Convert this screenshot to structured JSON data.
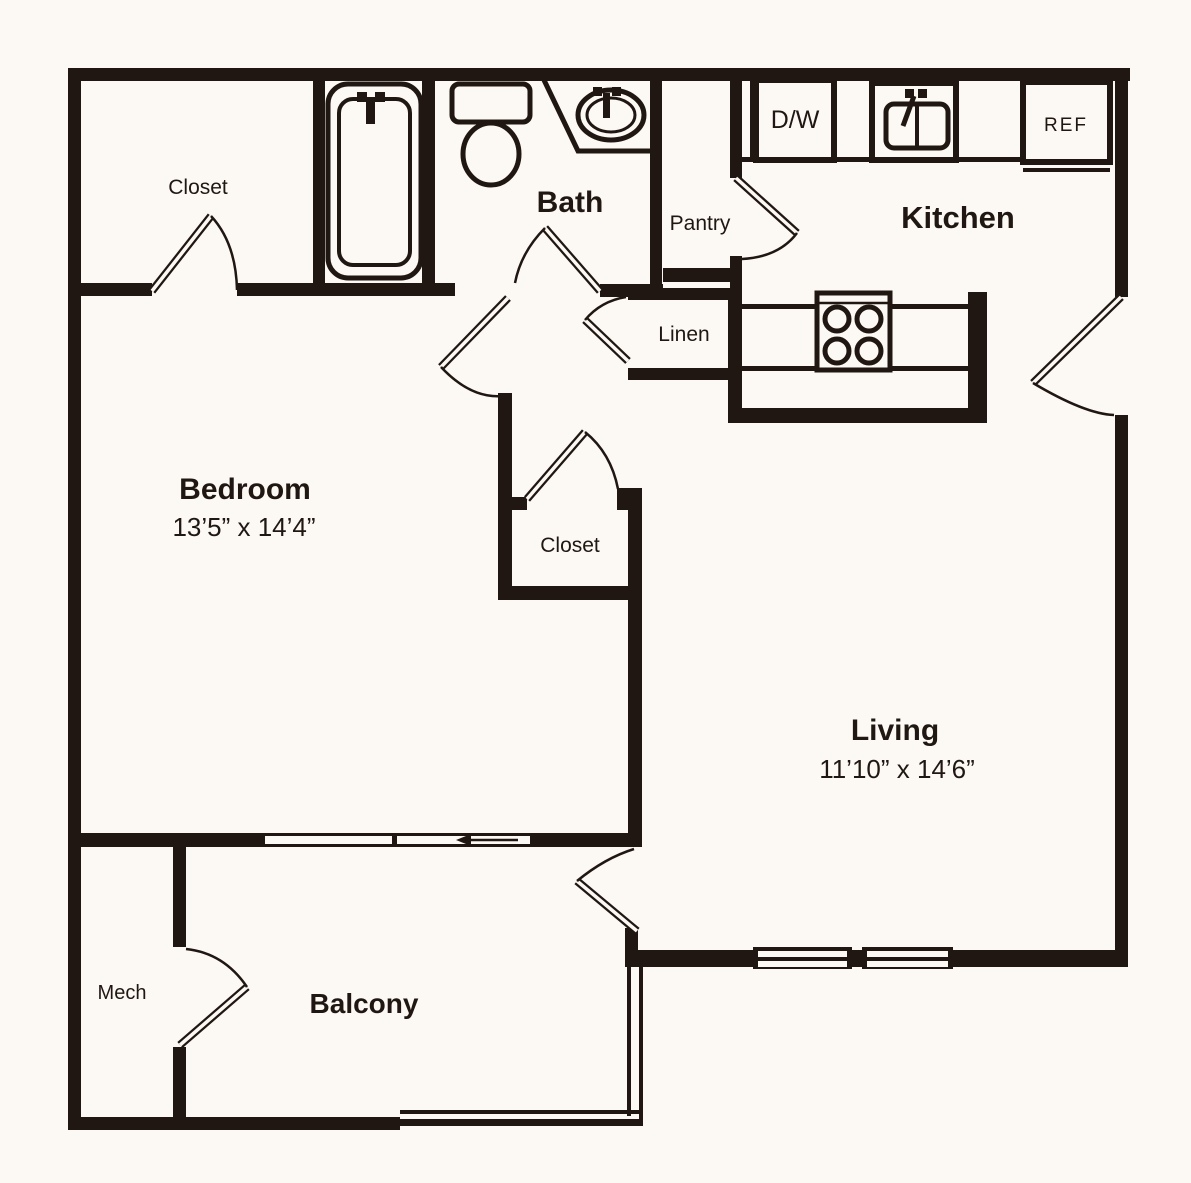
{
  "title": "One-bedroom apartment floor plan",
  "colors": {
    "wall": "#201712",
    "background": "#fcf8f3"
  },
  "rooms": {
    "closet_top": {
      "label": "Closet"
    },
    "bath": {
      "label": "Bath"
    },
    "pantry": {
      "label": "Pantry"
    },
    "kitchen": {
      "label": "Kitchen"
    },
    "linen": {
      "label": "Linen"
    },
    "bedroom": {
      "label": "Bedroom",
      "dimensions": "13’5” x 14’4”"
    },
    "closet_middle": {
      "label": "Closet"
    },
    "living": {
      "label": "Living",
      "dimensions": "11’10” x 14’6”"
    },
    "mech": {
      "label": "Mech"
    },
    "balcony": {
      "label": "Balcony"
    }
  },
  "appliances": {
    "dishwasher_label": "D/W",
    "refrigerator_label": "REF"
  }
}
